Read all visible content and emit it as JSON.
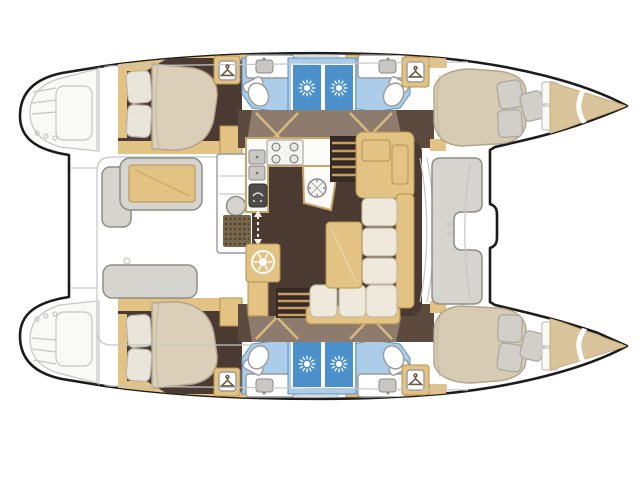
{
  "meta": {
    "title": "Catamaran yacht interior layout — top-view floor plan",
    "type": "floorplan",
    "orientation": "bows to the right, sterns with transom steps to the left"
  },
  "palette": {
    "background": "#ffffff",
    "outline": "#1c1c1c",
    "sketch": "#c5c5c5",
    "deck_white": "#f9f9f7",
    "wood": "#e3c384",
    "wood_deep": "#d9ba7e",
    "wood_edge": "#b6924f",
    "floor_brown": "#4a3a31",
    "steps": "#352a24",
    "step_line": "#c89d62",
    "corridor": "#8d7c6d",
    "corridor_dark": "#5d4a3e",
    "mattress": "#dbcfb9",
    "mattress_light": "#d8cbb4",
    "mattress_edge": "#b3a48c",
    "pillow": "#e9e5da",
    "pillow_edge": "#b9b4a8",
    "pillow_gray": "#d2cfc8",
    "pillow_gray_edge": "#a9a69f",
    "cushion": "#efe9dc",
    "cushion_edge": "#c4b9a4",
    "bench": "#d6d4cf",
    "bench_edge": "#8f8d86",
    "bath_floor": "#accdea",
    "bath_edge": "#5b8fbe",
    "shower_blue": "#4c90cb",
    "fixture_white": "#ffffff",
    "fixture_edge": "#9a9a9a",
    "counter_white": "#fbfbf9",
    "counter_edge": "#c9a768",
    "appliance_gray": "#c9c7c2",
    "appliance_edge": "#8a8a8a",
    "oven_dark": "#4e4c48",
    "grate": "#77654c",
    "grate_dot": "#4a3c2c",
    "bow_wood": "#d9c49c",
    "bow_wood_edge": "#c9ab72",
    "icon_line": "#6b5a42",
    "arrow": "#f5efe2"
  },
  "legend": {
    "vessel": "twin-hull sailing catamaran",
    "view": "top-down interior arrangement drawing, no text labels in drawing",
    "cabins": [
      "port aft double cabin with island berth",
      "port forward double cabin with berth in bow",
      "starboard aft double cabin with island berth",
      "starboard forward double cabin with berth in bow"
    ],
    "heads": [
      "port aft head: toilet, sink, shower stall",
      "port forward head: toilet, sink, shower stall",
      "starboard aft head: toilet, sink, shower stall",
      "starboard forward head: toilet, sink, shower stall"
    ],
    "saloon": [
      "L-shaped galley with 4-burner stove, double sink, oven and round sink",
      "washing-machine cabinet",
      "chart-table cabinet",
      "L-shaped sofa with saloon table",
      "companionway stairs down to port hull",
      "companionway stairs down to starboard hull",
      "sliding-door passage arrow"
    ],
    "cockpit": [
      "cockpit table with bench",
      "side bench",
      "aft bench",
      "wet bar module with grill and teak grate",
      "port transom steps",
      "starboard transom steps"
    ],
    "foredeck": [
      "forward cockpit C-shaped seat",
      "forward crossbeam notch"
    ],
    "icons": {
      "shower": "sun-rays icon",
      "wardrobe": "clothes-hanger icon",
      "washing_machine": "wheel-spokes icon"
    }
  }
}
